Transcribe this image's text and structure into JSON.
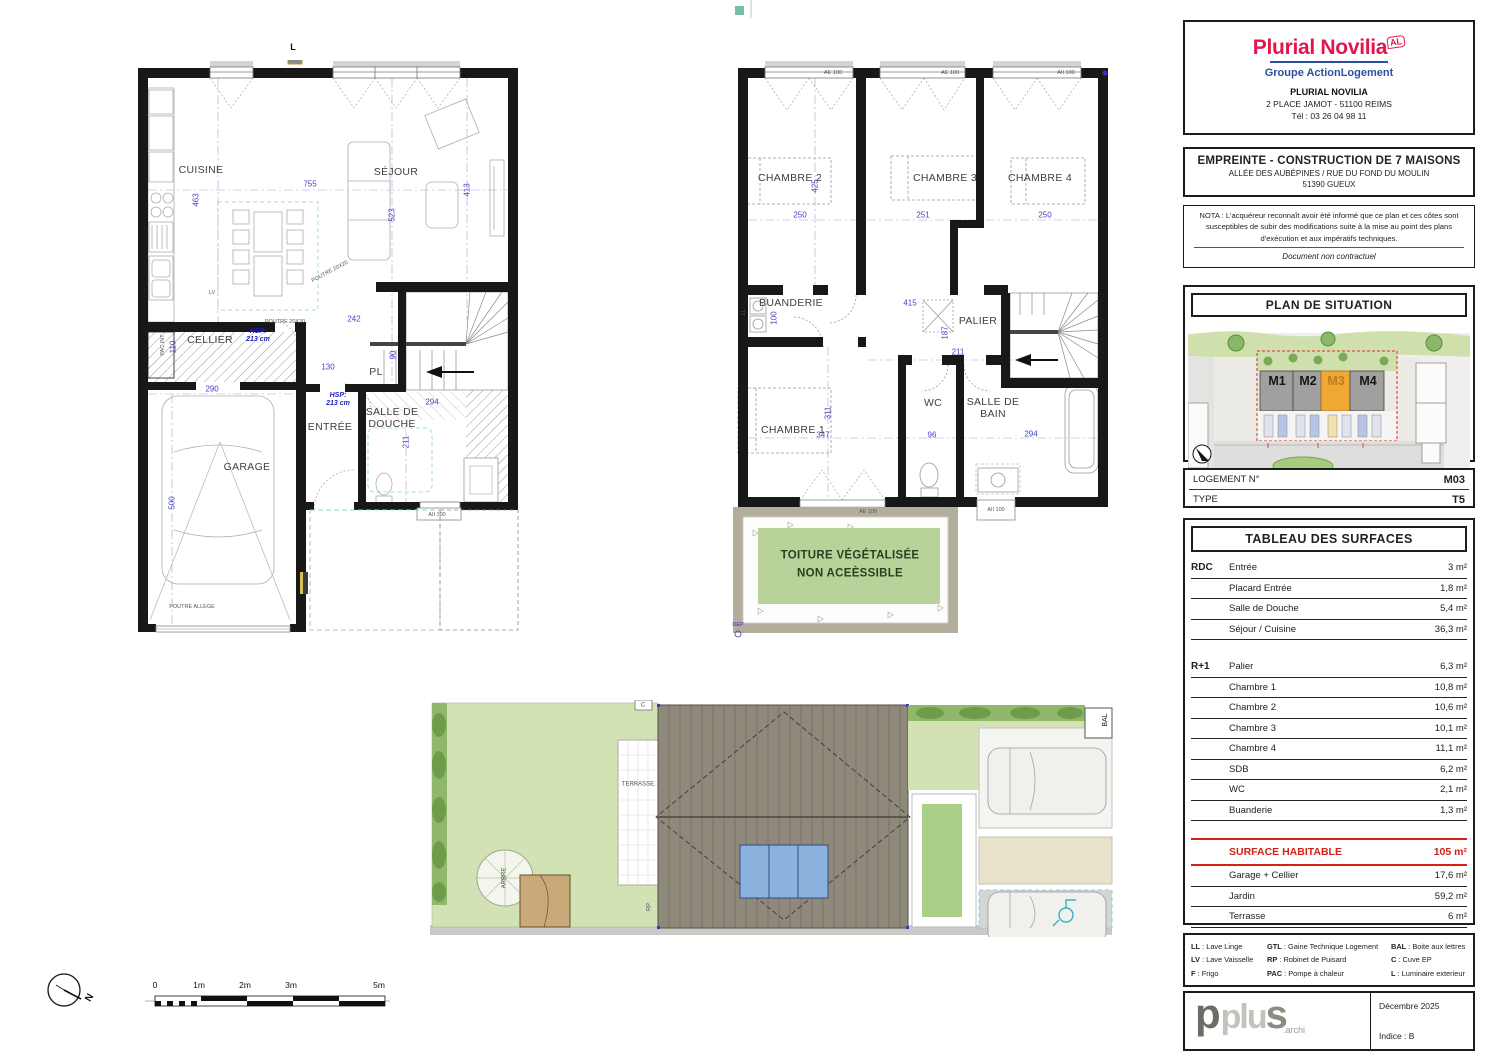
{
  "title_block": {
    "logo": {
      "brand": "Plurial Novilia",
      "badge": "AL",
      "group": "Groupe ActionLogement",
      "brand_color": "#e2164f",
      "group_color": "#2b529e"
    },
    "address": {
      "name": "PLURIAL NOVILIA",
      "line1": "2 PLACE JAMOT - 51100 REIMS",
      "line2": "Tél : 03 26 04 98 11"
    },
    "project": {
      "title": "EMPREINTE - CONSTRUCTION DE 7 MAISONS",
      "line1": "ALLÉE DES AUBÉPINES / RUE DU FOND DU MOULIN",
      "line2": "51390 GUEUX"
    },
    "nota": {
      "text": "NOTA : L'acquéreur reconnaît avoir été informé que ce plan et ces côtes sont susceptibles de subir des modifications suite à la mise au point des plans d'exécution et aux impératifs techniques.",
      "doc": "Document non contractuel"
    },
    "situation": {
      "title": "PLAN DE SITUATION",
      "highlighted": "M3",
      "highlight_color": "#f0a733"
    },
    "logement": {
      "label": "LOGEMENT N°",
      "value": "M03",
      "type_label": "TYPE",
      "type_value": "T5"
    }
  },
  "surfaces": {
    "title": "TABLEAU DES SURFACES",
    "rdc_label": "RDC",
    "r1_label": "R+1",
    "rdc": [
      {
        "name": "Entrée",
        "area": "3 m²"
      },
      {
        "name": "Placard Entrée",
        "area": "1,8 m²"
      },
      {
        "name": "Salle de Douche",
        "area": "5,4 m²"
      },
      {
        "name": "Séjour / Cuisine",
        "area": "36,3 m²"
      }
    ],
    "r1": [
      {
        "name": "Palier",
        "area": "6,3 m²"
      },
      {
        "name": "Chambre 1",
        "area": "10,8 m²"
      },
      {
        "name": "Chambre 2",
        "area": "10,6 m²"
      },
      {
        "name": "Chambre 3",
        "area": "10,1 m²"
      },
      {
        "name": "Chambre 4",
        "area": "11,1 m²"
      },
      {
        "name": "SDB",
        "area": "6,2 m²"
      },
      {
        "name": "WC",
        "area": "2,1 m²"
      },
      {
        "name": "Buanderie",
        "area": "1,3 m²"
      }
    ],
    "habitable": {
      "name": "SURFACE HABITABLE",
      "area": "105 m²",
      "color": "#d42015"
    },
    "annex": [
      {
        "name": "Garage + Cellier",
        "area": "17,6 m²"
      },
      {
        "name": "Jardin",
        "area": "59,2 m²"
      },
      {
        "name": "Terrasse",
        "area": "6 m²"
      },
      {
        "name": "Abri Jardin",
        "area": "2 m²"
      }
    ]
  },
  "legend": {
    "items": [
      {
        "k": "LL",
        "v": "Lave Linge"
      },
      {
        "k": "LV",
        "v": "Lave Vaisselle"
      },
      {
        "k": "F",
        "v": "Frigo"
      },
      {
        "k": "GTL",
        "v": "Gaine Technique Logement"
      },
      {
        "k": "RP",
        "v": "Robinet de Puisard"
      },
      {
        "k": "PAC",
        "v": "Pompe à chaleur"
      },
      {
        "k": "BAL",
        "v": "Boite aux lettres"
      },
      {
        "k": "C",
        "v": "Cuve EP"
      },
      {
        "k": "L",
        "v": "Luminaire exterieur"
      }
    ]
  },
  "footer": {
    "logo_a": "p",
    "logo_b": "plu",
    "logo_c": "s",
    "suffix": ".archi",
    "date": "Décembre 2025",
    "indice": "Indice : B"
  },
  "scalebar": {
    "labels": [
      "0",
      "1m",
      "2m",
      "3m",
      "5m"
    ]
  },
  "compass": {
    "north": "N"
  },
  "labels": [
    {
      "container": "rdc-labels",
      "cls": "room",
      "items": [
        {
          "t": "CUISINE",
          "x": 71,
          "y": 110
        },
        {
          "t": "SÉJOUR",
          "x": 266,
          "y": 112
        },
        {
          "t": "CELLIER",
          "x": 80,
          "y": 280
        },
        {
          "t": "GARAGE",
          "x": 117,
          "y": 407
        },
        {
          "t": "ENTRÉE",
          "x": 200,
          "y": 367
        },
        {
          "t": "SALLE DE\nDOUCHE",
          "x": 262,
          "y": 358
        },
        {
          "t": "PL",
          "x": 246,
          "y": 312
        }
      ]
    },
    {
      "container": "rdc-labels",
      "cls": "dim",
      "items": [
        {
          "t": "755",
          "x": 180,
          "y": 124
        },
        {
          "t": "463",
          "x": 66,
          "y": 140,
          "r": -90
        },
        {
          "t": "523",
          "x": 262,
          "y": 155,
          "r": -90
        },
        {
          "t": "413",
          "x": 337,
          "y": 130,
          "r": -90
        },
        {
          "t": "242",
          "x": 224,
          "y": 259
        },
        {
          "t": "130",
          "x": 198,
          "y": 307
        },
        {
          "t": "90",
          "x": 263,
          "y": 295,
          "r": -90
        },
        {
          "t": "290",
          "x": 82,
          "y": 329
        },
        {
          "t": "500",
          "x": 42,
          "y": 443,
          "r": -90
        },
        {
          "t": "110",
          "x": 43,
          "y": 287,
          "r": -90
        },
        {
          "t": "294",
          "x": 302,
          "y": 342
        },
        {
          "t": "211",
          "x": 276,
          "y": 382,
          "r": -90
        }
      ]
    },
    {
      "container": "rdc-labels",
      "cls": "note",
      "items": [
        {
          "t": "HSP:\n213 cm",
          "x": 128,
          "y": 276
        },
        {
          "t": "HSP:\n213 cm",
          "x": 208,
          "y": 340
        }
      ]
    },
    {
      "container": "rdc-labels",
      "cls": "tiny",
      "items": [
        {
          "t": "LV",
          "x": 82,
          "y": 233
        },
        {
          "t": "PAC INT",
          "x": 33,
          "y": 285,
          "r": -90
        },
        {
          "t": "POUTRE 20X20",
          "x": 200,
          "y": 212,
          "r": -28
        },
        {
          "t": "POUTRE 20X20",
          "x": 155,
          "y": 262
        },
        {
          "t": "POUTRE ALLEGE",
          "x": 62,
          "y": 547
        },
        {
          "t": "AII 100",
          "x": 307,
          "y": 455
        }
      ]
    },
    {
      "container": "r1-labels",
      "cls": "room",
      "items": [
        {
          "t": "CHAMBRE 2",
          "x": 62,
          "y": 118
        },
        {
          "t": "CHAMBRE 3",
          "x": 217,
          "y": 118
        },
        {
          "t": "CHAMBRE 4",
          "x": 312,
          "y": 118
        },
        {
          "t": "BUANDERIE",
          "x": 63,
          "y": 243
        },
        {
          "t": "PALIER",
          "x": 250,
          "y": 261
        },
        {
          "t": "CHAMBRE 1",
          "x": 65,
          "y": 370
        },
        {
          "t": "WC",
          "x": 205,
          "y": 343
        },
        {
          "t": "SALLE DE\nBAIN",
          "x": 265,
          "y": 348
        }
      ]
    },
    {
      "container": "r1-labels",
      "cls": "dim",
      "items": [
        {
          "t": "425",
          "x": 87,
          "y": 126,
          "r": -90
        },
        {
          "t": "250",
          "x": 72,
          "y": 155
        },
        {
          "t": "251",
          "x": 195,
          "y": 155
        },
        {
          "t": "250",
          "x": 317,
          "y": 155
        },
        {
          "t": "415",
          "x": 182,
          "y": 243
        },
        {
          "t": "187",
          "x": 217,
          "y": 273,
          "r": -90
        },
        {
          "t": "211",
          "x": 230,
          "y": 292
        },
        {
          "t": "100",
          "x": 46,
          "y": 258,
          "r": -90
        },
        {
          "t": "347",
          "x": 95,
          "y": 375
        },
        {
          "t": "311",
          "x": 100,
          "y": 353,
          "r": -90
        },
        {
          "t": "96",
          "x": 204,
          "y": 375
        },
        {
          "t": "294",
          "x": 303,
          "y": 374
        }
      ]
    },
    {
      "container": "r1-labels",
      "cls": "winlbl",
      "items": [
        {
          "t": "AE 100",
          "x": 105,
          "y": 13
        },
        {
          "t": "AE 100",
          "x": 222,
          "y": 13
        },
        {
          "t": "AII 100",
          "x": 338,
          "y": 13
        },
        {
          "t": "AE 100",
          "x": 140,
          "y": 452
        },
        {
          "t": "AII 100",
          "x": 268,
          "y": 450
        }
      ]
    },
    {
      "container": "r1-labels",
      "cls": "toit",
      "items": [
        {
          "t": "TOITURE VÉGÉTALISÉE",
          "x": 122,
          "y": 496
        },
        {
          "t": "NON ACEÈSSIBLE",
          "x": 122,
          "y": 514
        }
      ]
    },
    {
      "container": "r1-labels",
      "cls": "tiny",
      "items": [
        {
          "t": "DEP",
          "x": 10,
          "y": 565,
          "c": "#2a2ac0"
        },
        {
          "t": "LL",
          "x": 16,
          "y": 252,
          "r": -90
        }
      ]
    },
    {
      "container": "site-labels",
      "cls": "site",
      "items": [
        {
          "t": "TERRASSE",
          "x": 208,
          "y": 85
        },
        {
          "t": "ARBRE",
          "x": 75,
          "y": 178,
          "r": -90,
          "c": "#2d5a1e"
        },
        {
          "t": "RP",
          "x": 220,
          "y": 207,
          "r": -90
        },
        {
          "t": "C",
          "x": 213,
          "y": 6
        },
        {
          "t": "BAL",
          "x": 676,
          "y": 20,
          "r": -90,
          "c": "#111",
          "fs": 7
        }
      ]
    },
    {
      "container": "map-labels",
      "cls": "mlabel",
      "items": [
        {
          "t": "M1",
          "x": 88,
          "y": 68
        },
        {
          "t": "M2",
          "x": 119,
          "y": 68
        },
        {
          "t": "M3",
          "x": 147,
          "y": 68,
          "c": "#bd7d1e"
        },
        {
          "t": "M4",
          "x": 179,
          "y": 68
        }
      ]
    },
    {
      "container": "page-labels",
      "cls": "plabel",
      "items": [
        {
          "t": "L",
          "x": 293,
          "y": 47
        }
      ]
    },
    {
      "container": "compass-main",
      "cls": "plabel",
      "items": [
        {
          "t": "N",
          "x": 50,
          "y": 30,
          "r": -60,
          "fs": 10
        }
      ]
    }
  ]
}
